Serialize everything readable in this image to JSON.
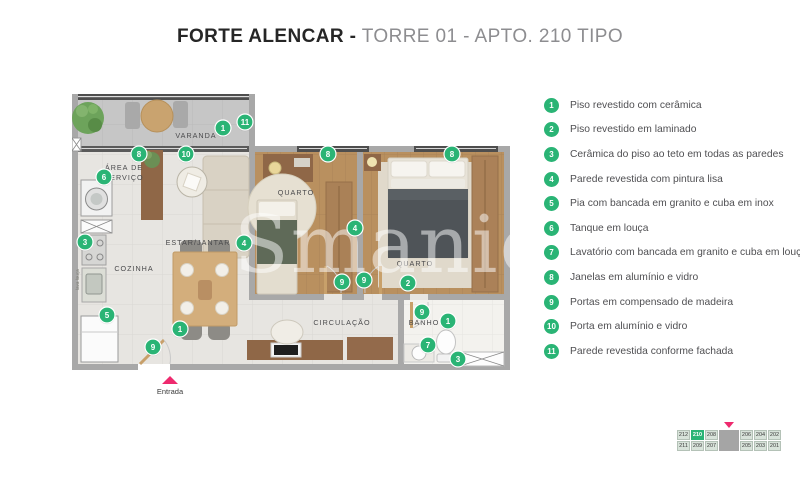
{
  "title": {
    "bold": "FORTE ALENCAR -",
    "regular": " TORRE 01 - APTO. 210 TIPO"
  },
  "legend": [
    {
      "num": "1",
      "text": "Piso revestido com cerâmica"
    },
    {
      "num": "2",
      "text": "Piso revestido em laminado"
    },
    {
      "num": "3",
      "text": "Cerâmica do piso ao teto em todas as paredes"
    },
    {
      "num": "4",
      "text": "Parede revestida com pintura lisa"
    },
    {
      "num": "5",
      "text": "Pia com bancada em granito e cuba em inox"
    },
    {
      "num": "6",
      "text": "Tanque em louça"
    },
    {
      "num": "7",
      "text": "Lavatório com bancada em granito e cuba em louça"
    },
    {
      "num": "8",
      "text": "Janelas em alumínio e vidro"
    },
    {
      "num": "9",
      "text": "Portas em compensado de madeira"
    },
    {
      "num": "10",
      "text": "Porta em alumínio e vidro"
    },
    {
      "num": "11",
      "text": "Parede revestida conforme fachada"
    }
  ],
  "plan": {
    "labels": [
      {
        "text": "VARANDA",
        "x": 124,
        "y": 44
      },
      {
        "text": "ÁREA DE",
        "x": 52,
        "y": 76
      },
      {
        "text": "SERVIÇO",
        "x": 52,
        "y": 86
      },
      {
        "text": "ESTAR/JANTAR",
        "x": 126,
        "y": 151
      },
      {
        "text": "COZINHA",
        "x": 62,
        "y": 177
      },
      {
        "text": "QUARTO",
        "x": 224,
        "y": 101
      },
      {
        "text": "QUARTO",
        "x": 343,
        "y": 172
      },
      {
        "text": "CIRCULAÇÃO",
        "x": 270,
        "y": 231
      },
      {
        "text": "BANHO",
        "x": 352,
        "y": 231
      }
    ],
    "markers": [
      {
        "n": "1",
        "x": 151,
        "y": 34
      },
      {
        "n": "11",
        "x": 173,
        "y": 28
      },
      {
        "n": "8",
        "x": 67,
        "y": 60
      },
      {
        "n": "10",
        "x": 114,
        "y": 60
      },
      {
        "n": "8",
        "x": 256,
        "y": 60
      },
      {
        "n": "8",
        "x": 380,
        "y": 60
      },
      {
        "n": "6",
        "x": 32,
        "y": 83
      },
      {
        "n": "3",
        "x": 13,
        "y": 148
      },
      {
        "n": "4",
        "x": 172,
        "y": 149
      },
      {
        "n": "4",
        "x": 283,
        "y": 134
      },
      {
        "n": "9",
        "x": 270,
        "y": 188
      },
      {
        "n": "9",
        "x": 292,
        "y": 186
      },
      {
        "n": "2",
        "x": 336,
        "y": 189
      },
      {
        "n": "5",
        "x": 35,
        "y": 221
      },
      {
        "n": "1",
        "x": 108,
        "y": 235
      },
      {
        "n": "9",
        "x": 81,
        "y": 253
      },
      {
        "n": "9",
        "x": 350,
        "y": 218
      },
      {
        "n": "1",
        "x": 376,
        "y": 227
      },
      {
        "n": "7",
        "x": 356,
        "y": 251
      },
      {
        "n": "3",
        "x": 386,
        "y": 265
      }
    ],
    "watermark": "Smaniot",
    "appliance_label": "lava louça",
    "entrance": {
      "label": "Entrada"
    }
  },
  "keyplan": {
    "top": [
      "212",
      "210",
      "208",
      "206",
      "204",
      "202"
    ],
    "bottom": [
      "211",
      "209",
      "207",
      "205",
      "203",
      "201"
    ],
    "highlight": "210"
  },
  "colors": {
    "marker": "#2ab475",
    "entrance_arrow": "#ee2a6e",
    "wall": "#a8a8a8",
    "facade": "#4e4e4e",
    "wood_floor": "#b9905f",
    "tile_floor": "#e7e5e1",
    "balcony_floor": "#c6c6c6",
    "bath_floor": "#f3f2ee"
  }
}
